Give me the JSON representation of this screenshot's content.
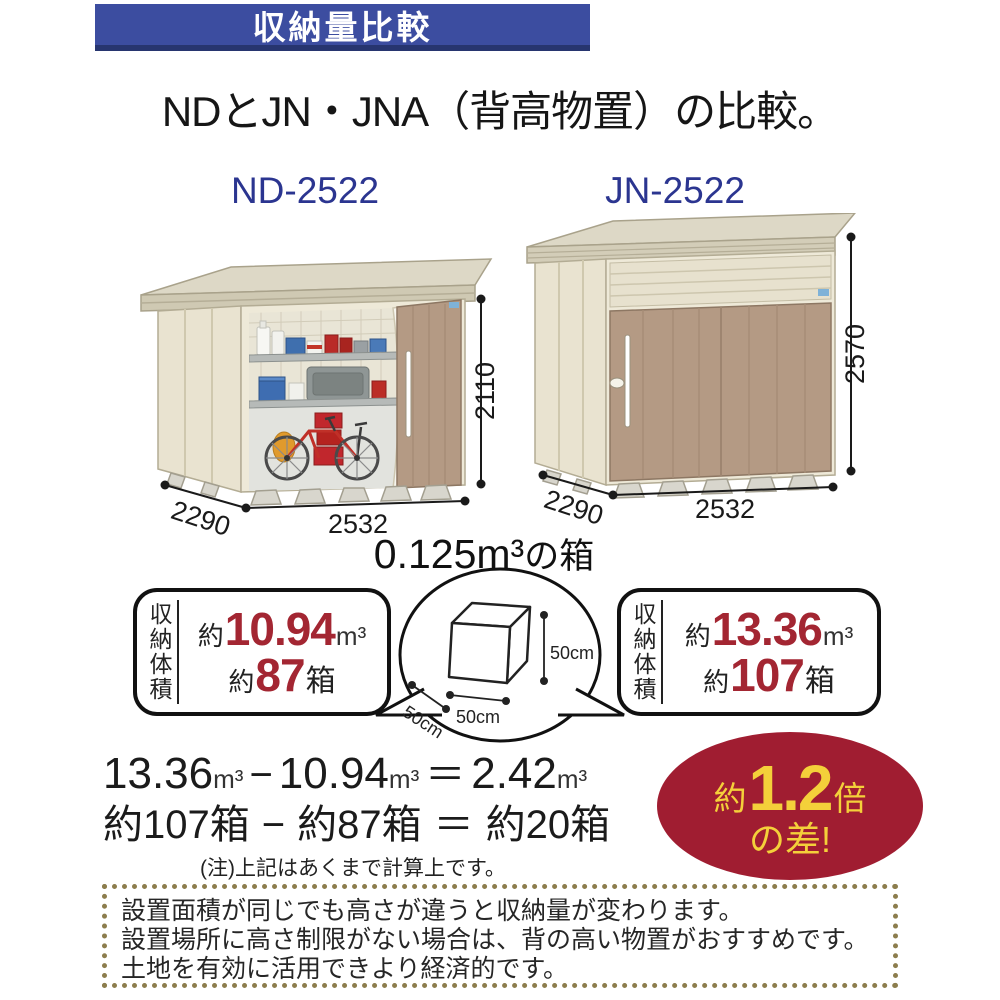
{
  "banner": {
    "title": "収納量比較"
  },
  "heading": "NDとJN・JNA（背高物置）の比較。",
  "sheds": {
    "left": {
      "model": "ND-2522",
      "height": "2110",
      "depth": "2290",
      "width": "2532"
    },
    "right": {
      "model": "JN-2522",
      "height": "2570",
      "depth": "2290",
      "width": "2532"
    }
  },
  "box_demo": {
    "title_value": "0.125m³",
    "title_suffix": "の箱",
    "side_h": "50cm",
    "side_w": "50cm",
    "side_d": "50cm"
  },
  "stats": {
    "left": {
      "label": "収納体積",
      "vol_approx": "約",
      "vol_value": "10.94",
      "vol_unit": "m³",
      "box_approx": "約",
      "box_value": "87",
      "box_unit": "箱"
    },
    "right": {
      "label": "収納体積",
      "vol_approx": "約",
      "vol_value": "13.36",
      "vol_unit": "m³",
      "box_approx": "約",
      "box_value": "107",
      "box_unit": "箱"
    }
  },
  "calc": {
    "l1v1": "13.36",
    "l1u1": "m³",
    "l1op": "−",
    "l1v2": "10.94",
    "l1u2": "m³",
    "l1eq": "＝",
    "l1v3": "2.42",
    "l1u3": "m³",
    "l2v1": "約107箱",
    "l2op": "−",
    "l2v2": "約87箱",
    "l2eq": "＝",
    "l2v3": "約20箱",
    "note": "(注)上記はあくまで計算上です。"
  },
  "badge": {
    "approx": "約",
    "value": "1.2",
    "times": "倍",
    "line2": "の差!"
  },
  "footer": {
    "line1": "設置面積が同じでも高さが違うと収納量が変わります。",
    "line2": "設置場所に高さ制限がない場合は、背の高い物置がおすすめです。",
    "line3": "土地を有効に活用できより経済的です。"
  },
  "colors": {
    "banner_blue": "#3c4da0",
    "model_blue": "#2b3590",
    "number_red": "#a32632",
    "badge_red": "#a01d31",
    "badge_yellow": "#f4d03a",
    "door_tan": "#b49a84",
    "wall_cream": "#eee9d8",
    "dot_border": "#8c7d4d"
  }
}
